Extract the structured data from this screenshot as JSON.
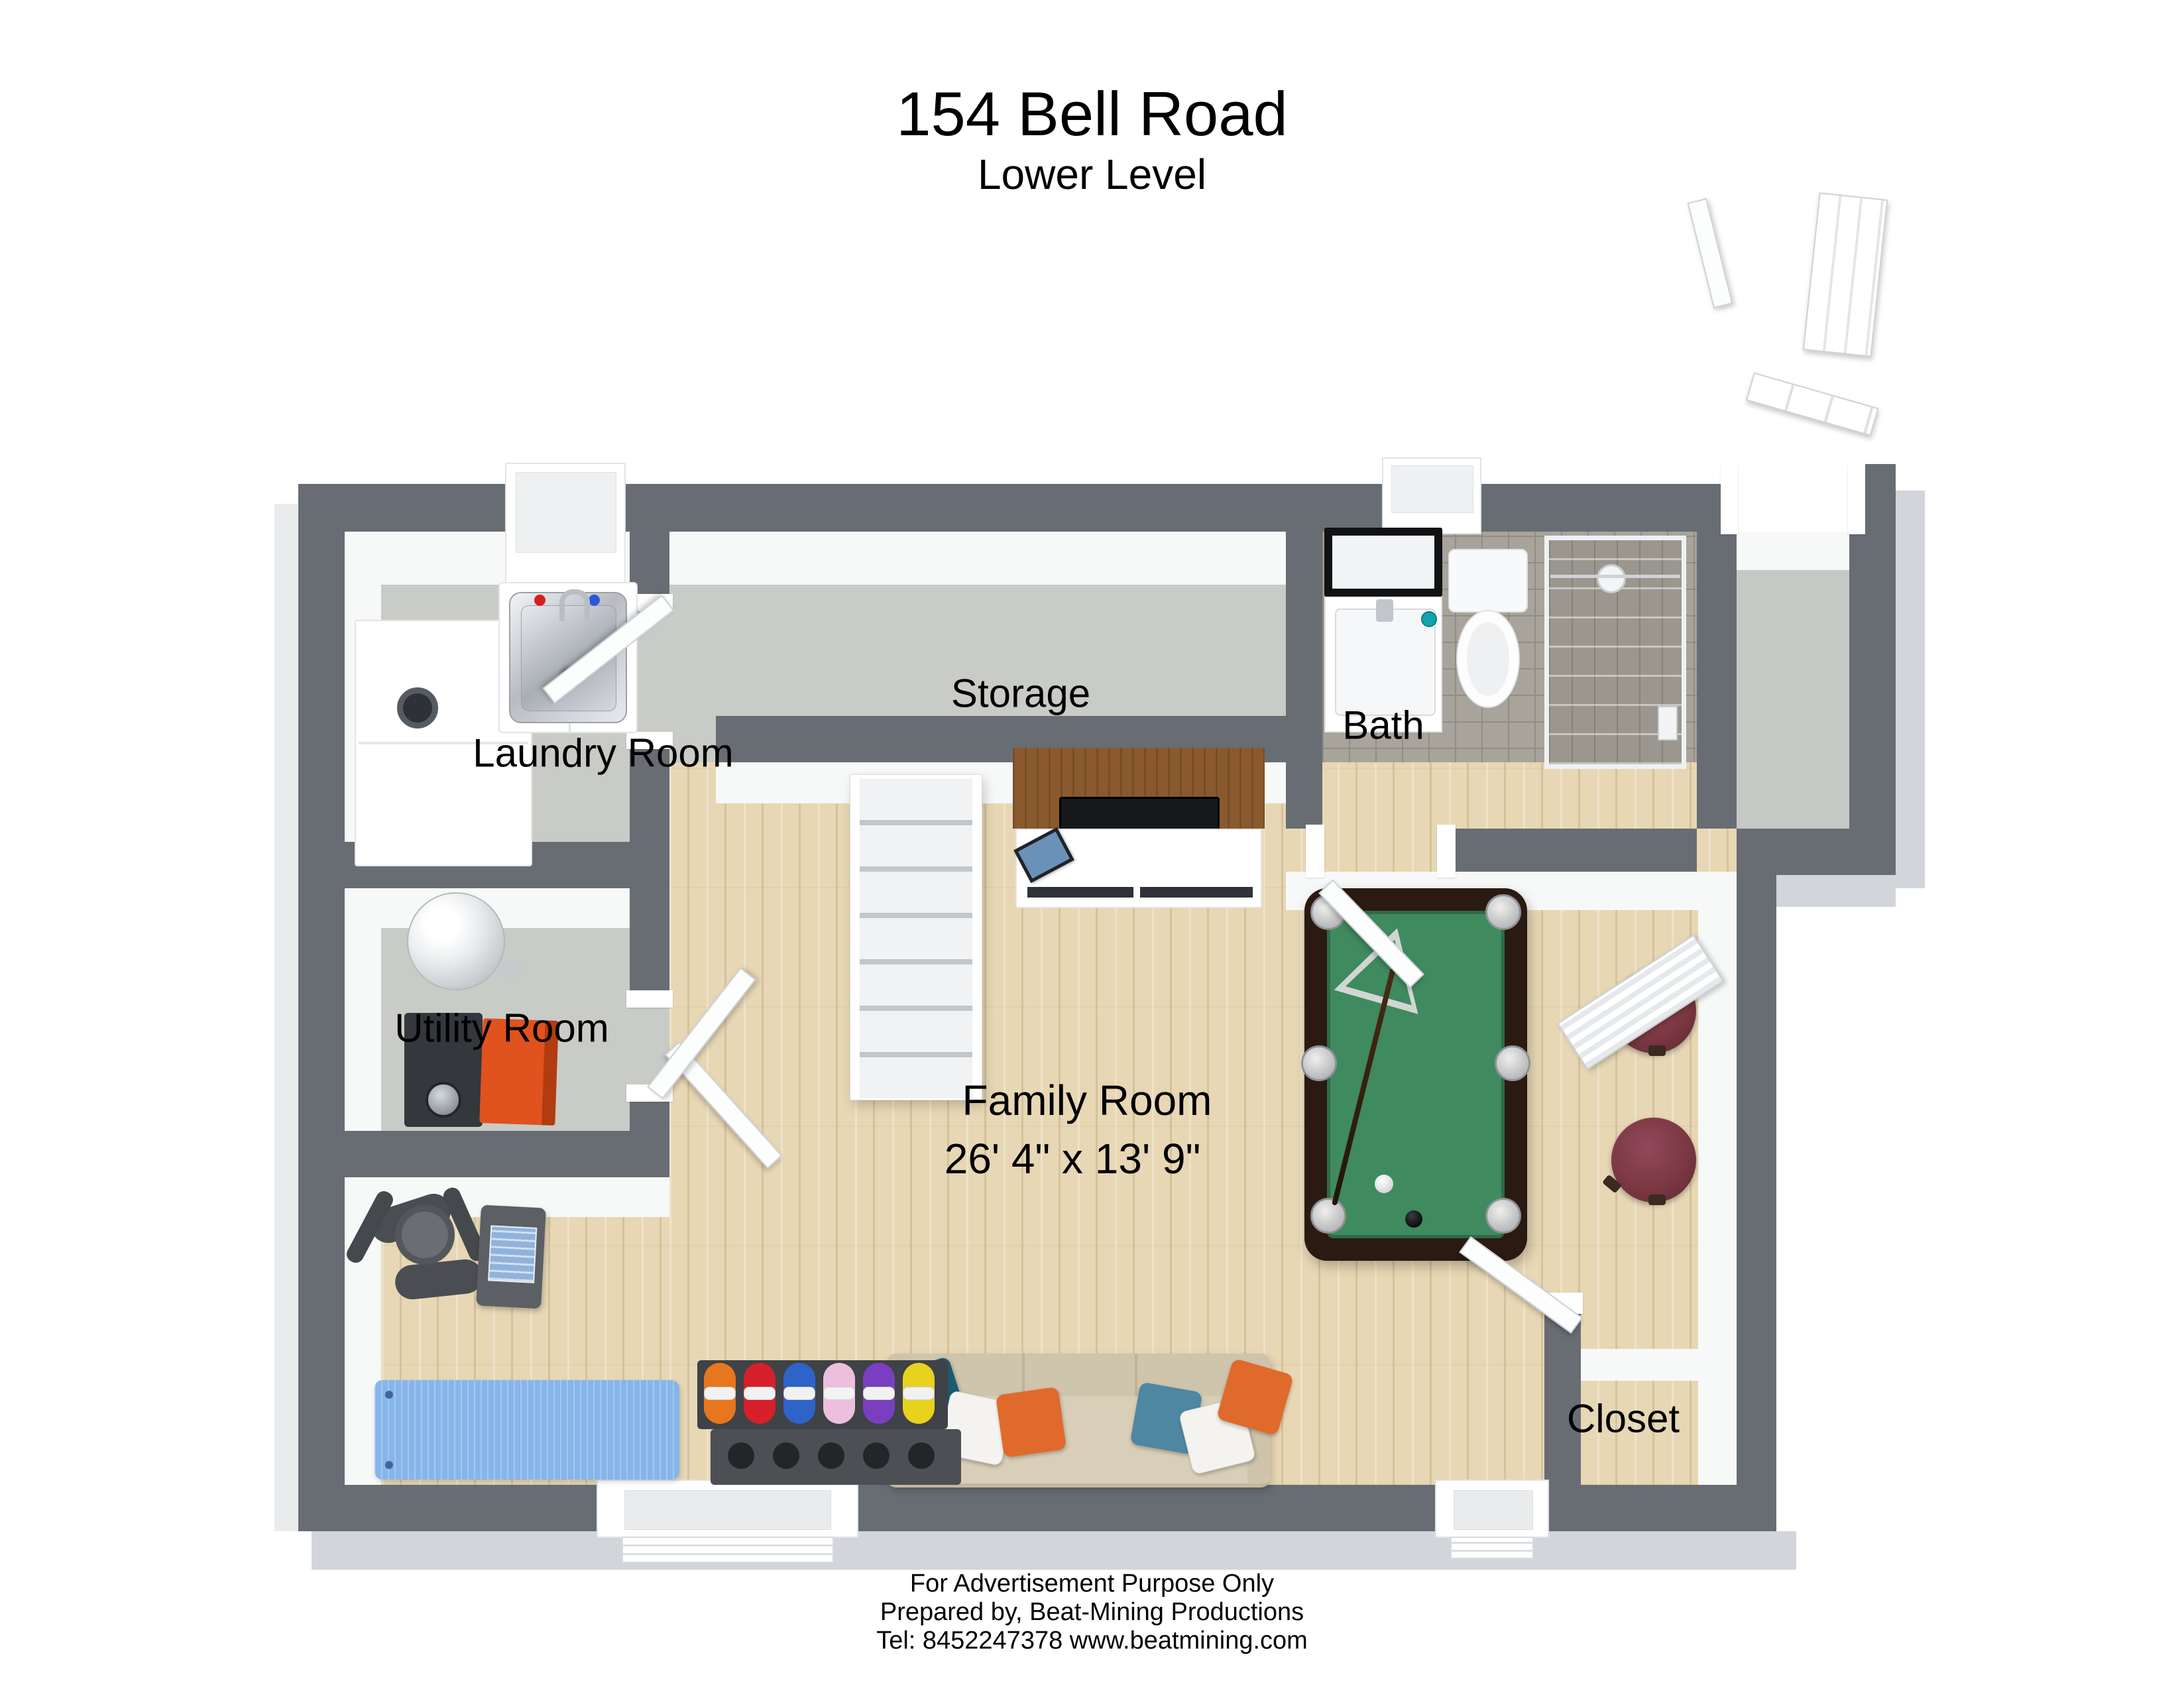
{
  "header": {
    "title": "154 Bell Road",
    "subtitle": "Lower Level"
  },
  "rooms": {
    "laundry": {
      "label": "Laundry Room"
    },
    "storage": {
      "label": "Storage"
    },
    "bath": {
      "label": "Bath"
    },
    "utility": {
      "label": "Utility Room"
    },
    "family": {
      "label": "Family Room",
      "dimensions": "26' 4\" x 13' 9\""
    },
    "closet": {
      "label": "Closet"
    }
  },
  "footer": {
    "line1": "For Advertisement Purpose Only",
    "line2": "Prepared by, Beat-Mining Productions",
    "line3": "Tel: 8452247378 www.beatmining.com"
  },
  "colors": {
    "wall": "#686d74",
    "hard_floor": "#c9cbc7",
    "wood_floor": "#e7d7b4",
    "tile_floor": "#a8a49c",
    "pool_felt": "#3f8a5f",
    "pool_frame": "#2a1a12",
    "stool": "#7c3842",
    "yoga_mat": "#86b5ea",
    "sofa": "#d9ceb7",
    "pillow_teal": "#1c5a70",
    "pillow_orange": "#e06a2c",
    "pillow_blue": "#4e87a2",
    "furnace_orange": "#e0521e",
    "dumbbells": [
      "#e8761e",
      "#d6202a",
      "#2e64c8",
      "#ecc0dc",
      "#7a3fc0",
      "#e8d21e"
    ]
  }
}
